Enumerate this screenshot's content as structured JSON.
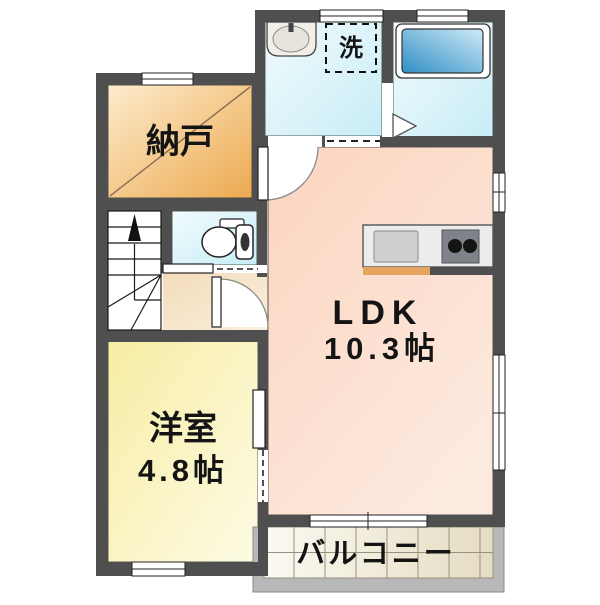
{
  "floorplan": {
    "kind": "japanese-apartment-floor-plan",
    "rooms": {
      "storage": {
        "label": "納戸"
      },
      "washroom": {
        "washer_label": "洗"
      },
      "ldk": {
        "label": "LDK",
        "size": "10.3帖"
      },
      "western_room": {
        "label": "洋室",
        "size": "4.8帖"
      },
      "balcony": {
        "label": "バルコニー"
      }
    },
    "fixtures": {
      "vanity_sink": "washroom vanity sink",
      "washing_machine_space": "dashed square washer space",
      "bathtub": "bathtub in unit bath",
      "toilet": "toilet with tank",
      "kitchen_counter": "kitchen counter with sink and 2-burner stove",
      "staircase": "staircase going up with winder treads"
    },
    "colors": {
      "wall": "#4f4f4f",
      "storage_room": "#efb266",
      "wet_area": "#d6f1f8",
      "bathtub": "#3390c5",
      "ldk_floor": "#fbd8c4",
      "western_room_floor": "#f8f1b2",
      "hallway_floor": "#f5e3c6",
      "balcony_tile": "#ece4cb",
      "balcony_frame": "#b8b8b8",
      "kitchen_strip": "#e6a55f"
    }
  }
}
